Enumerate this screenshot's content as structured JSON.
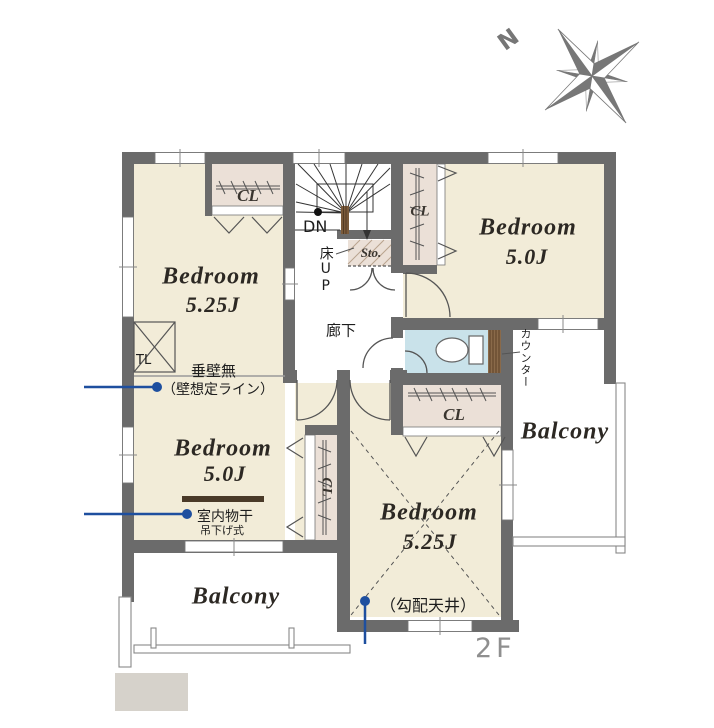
{
  "floor_label": "2F",
  "compass": {
    "north": "N"
  },
  "rooms": {
    "bedroom_nw": {
      "name": "Bedroom",
      "size": "5.25J"
    },
    "bedroom_ne": {
      "name": "Bedroom",
      "size": "5.0J"
    },
    "bedroom_w": {
      "name": "Bedroom",
      "size": "5.0J"
    },
    "bedroom_s": {
      "name": "Bedroom",
      "size": "5.25J"
    },
    "balcony_east": "Balcony",
    "balcony_southwest": "Balcony",
    "hallway": "廊下",
    "storage": "Sto.",
    "closet": "CL"
  },
  "stairs": {
    "down": "DN",
    "floor_up": "床UP"
  },
  "fixtures": {
    "counter": "カウンター",
    "top_light": "TL",
    "indoor_drying_rod": "室内物干",
    "hanging_type": "吊下げ式"
  },
  "notes": {
    "no_hanging_wall": "垂壁無",
    "assumed_wall_line": "（壁想定ライン）",
    "sloped_ceiling": "（勾配天井）"
  },
  "colors": {
    "wall": "#6b6b6b",
    "room_floor": "#f2ecd8",
    "closet_floor": "#ebe0d7",
    "toilet_floor": "#c9e2ea",
    "counter": "#8a6a4a",
    "annotation_blue": "#1e4f9f",
    "floor_label_gray": "#8f8f8f",
    "compass_gray": "#767676"
  }
}
